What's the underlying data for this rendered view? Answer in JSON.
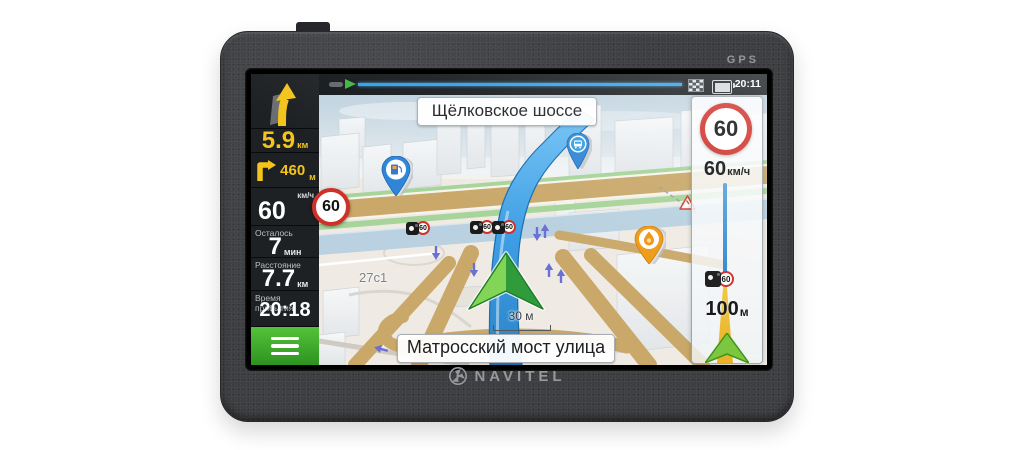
{
  "device": {
    "brand": "NAVITEL",
    "bezel_label": "GPS"
  },
  "status_bar": {
    "time": "20:11"
  },
  "sidebar": {
    "next_maneuver_distance": {
      "value": "5.9",
      "unit": "км"
    },
    "second_maneuver": {
      "value": "460",
      "unit": "м"
    },
    "speed": {
      "unit_label": "км/ч",
      "value": "60",
      "limit_badge": "60"
    },
    "stats": [
      {
        "label": "Осталось",
        "value": "7",
        "unit": "мин"
      },
      {
        "label": "Расстояние",
        "value": "7.7",
        "unit": "км"
      },
      {
        "label": "Время прибытия",
        "value": "20:18"
      }
    ]
  },
  "map": {
    "top_street": "Щёлковское шоссе",
    "bottom_street": "Матросский мост улица",
    "scale_label": "30 м",
    "building_label": "27с1",
    "cameras": [
      "60",
      "60",
      "60"
    ]
  },
  "right_panel": {
    "speed_limit": "60",
    "limit_text": {
      "value": "60",
      "unit": "км/ч"
    },
    "camera_limit": "60",
    "next_event_distance": {
      "value": "100",
      "unit": "м"
    }
  },
  "colors": {
    "accent_yellow": "#f4c41d",
    "route_blue": "#2e93dc",
    "menu_green": "#3aa625",
    "limit_red": "#cf3129"
  }
}
